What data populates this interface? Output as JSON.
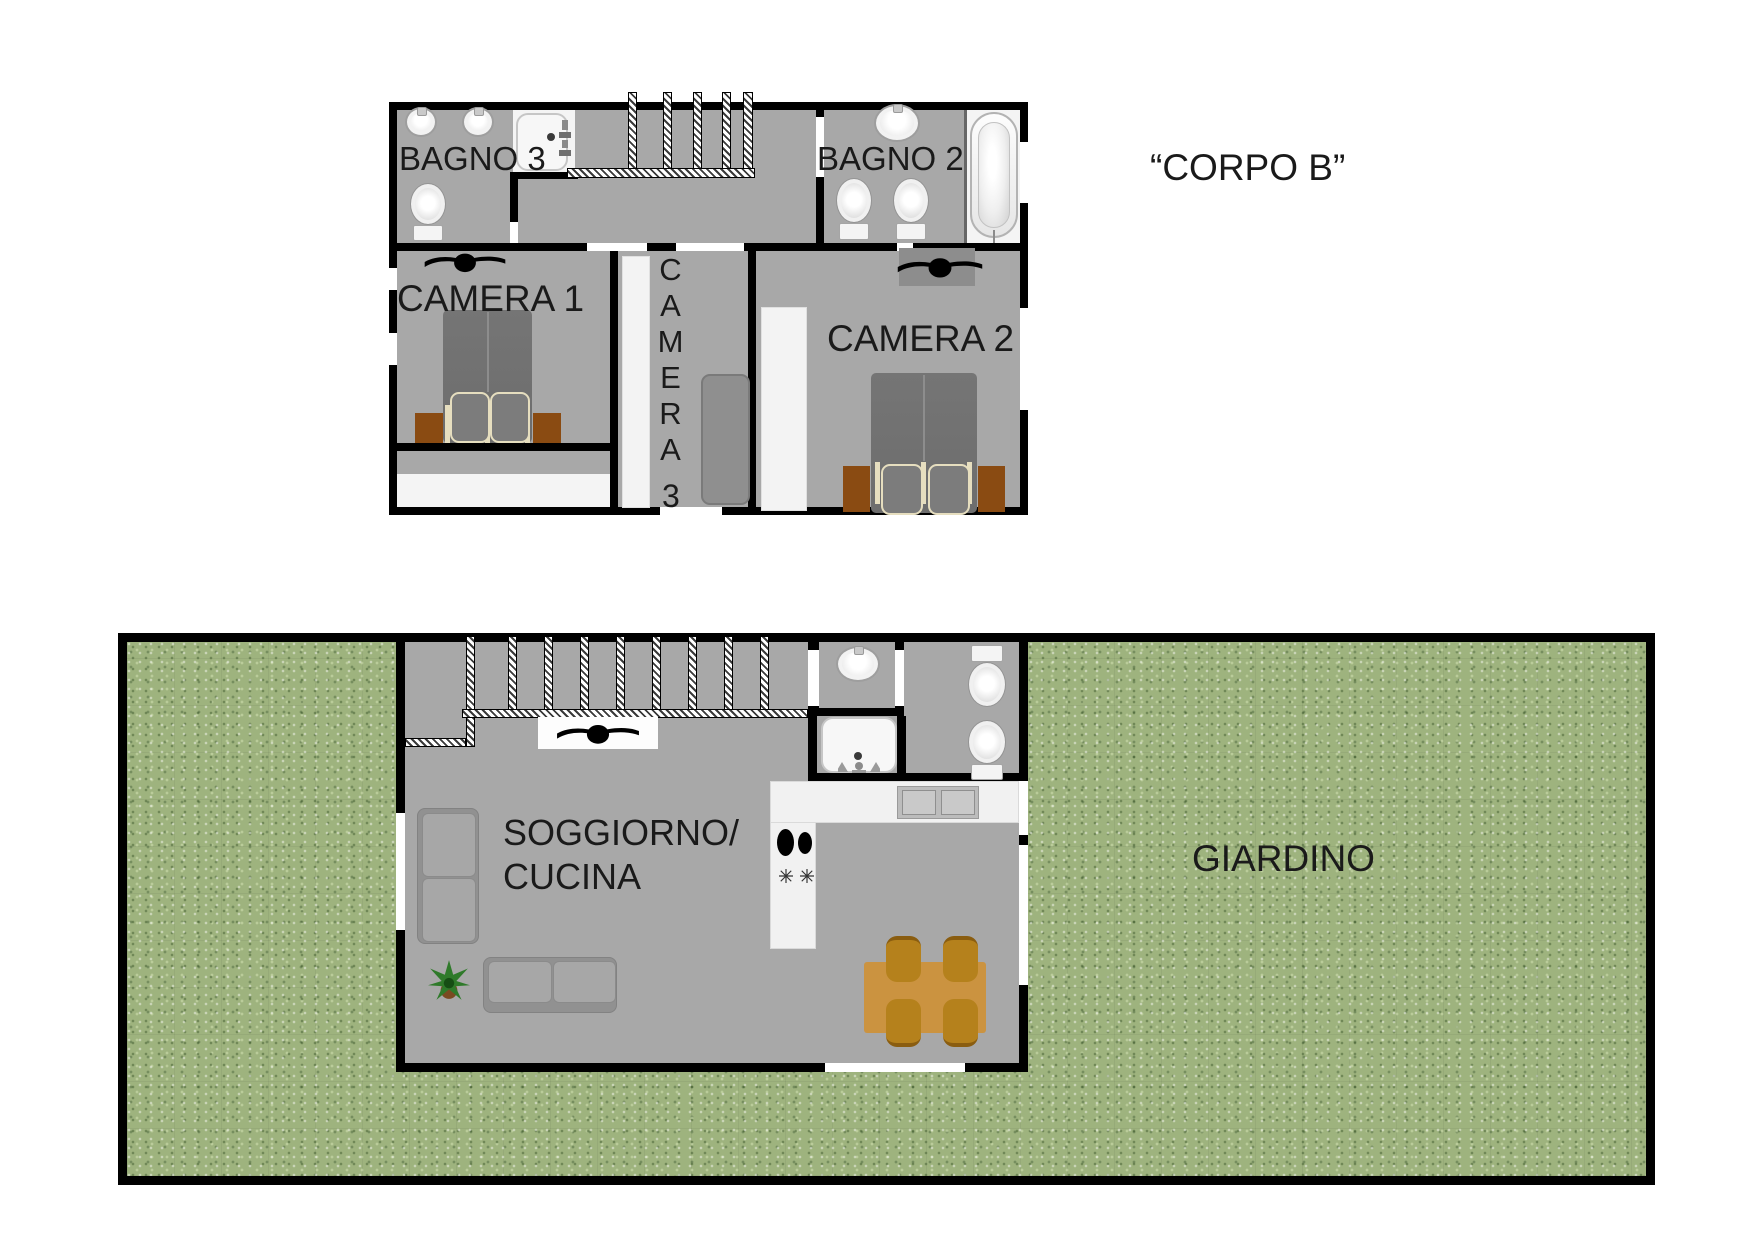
{
  "title": "“CORPO B”",
  "upper_floor": {
    "rooms": {
      "bagno3": {
        "label": "BAGNO 3"
      },
      "bagno2": {
        "label": "BAGNO 2"
      },
      "camera1": {
        "label": "CAMERA 1"
      },
      "camera2": {
        "label": "CAMERA 2"
      },
      "camera3": {
        "label": "CAMERA",
        "number": "3"
      }
    },
    "fixtures": {
      "bagno3": [
        "sink",
        "sink",
        "shower",
        "toilet"
      ],
      "bagno2": [
        "sink",
        "toilet",
        "toilet",
        "bathtub"
      ],
      "camera1": [
        "ceiling-fan",
        "double-bed",
        "nightstand",
        "nightstand"
      ],
      "camera2": [
        "ceiling-fan",
        "double-bed",
        "nightstand",
        "nightstand",
        "wardrobe"
      ],
      "camera3": [
        "wardrobe",
        "single-bed"
      ],
      "landing": [
        "staircase"
      ]
    }
  },
  "lower_floor": {
    "rooms": {
      "soggiorno_cucina": {
        "label_line1": "SOGGIORNO/",
        "label_line2": "CUCINA"
      },
      "giardino": {
        "label": "GIARDINO"
      }
    },
    "fixtures": {
      "soggiorno_cucina": [
        "staircase",
        "ceiling-fan",
        "armchair",
        "sofa",
        "plant",
        "stove",
        "kitchen-counter",
        "kitchen-sink",
        "dining-table",
        "chair",
        "chair",
        "chair",
        "chair"
      ],
      "bathroom": [
        "sink",
        "shower",
        "toilet",
        "toilet"
      ]
    }
  },
  "colors": {
    "wall": "#000000",
    "floor": "#a8a8a8",
    "garden": "#9eb37e",
    "text": "#1a1a1a",
    "wood_dark": "#8a4b12",
    "table_wood": "#cb9340",
    "chair_wood": "#b5811c",
    "bed_gray": "#757575",
    "fixture_white": "#f5f5f5"
  }
}
